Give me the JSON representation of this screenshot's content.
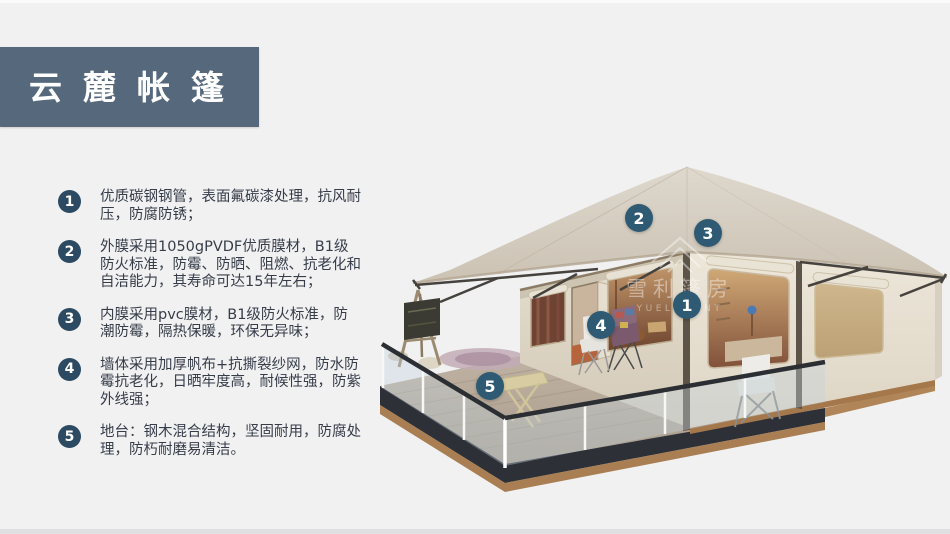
{
  "page": {
    "background": "#f1f1f2",
    "accent": "#56697c"
  },
  "header": {
    "title": "云麓帐篷",
    "bg_color": "#56697c",
    "text_color": "#ffffff"
  },
  "features": {
    "bullet_color": "#2c4a62",
    "items": [
      {
        "num": "1",
        "text": "优质碳钢钢管，表面氟碳漆处理，抗风耐压，防腐防锈；"
      },
      {
        "num": "2",
        "text": "外膜采用1050gPVDF优质膜材，B1级防火标准，防霉、防晒、阻燃、抗老化和自洁能力，其寿命可达15年左右；"
      },
      {
        "num": "3",
        "text": "内膜采用pvc膜材，B1级防火标准，防潮防霉，隔热保暖，环保无异味；"
      },
      {
        "num": "4",
        "text": "墙体采用加厚帆布+抗撕裂纱网，防水防霉抗老化，日晒牢度高，耐候性强，防紫外线强；"
      },
      {
        "num": "5",
        "text": "地台：钢木混合结构，坚固耐用，防腐处理，防朽耐磨易清洁。"
      }
    ]
  },
  "diagram": {
    "badge_color": "#2e5a73",
    "callouts": [
      {
        "num": "1"
      },
      {
        "num": "2"
      },
      {
        "num": "3"
      },
      {
        "num": "4"
      },
      {
        "num": "5"
      }
    ],
    "watermark": {
      "cn": "雪利篷房",
      "en": "YUELI TENT"
    }
  }
}
